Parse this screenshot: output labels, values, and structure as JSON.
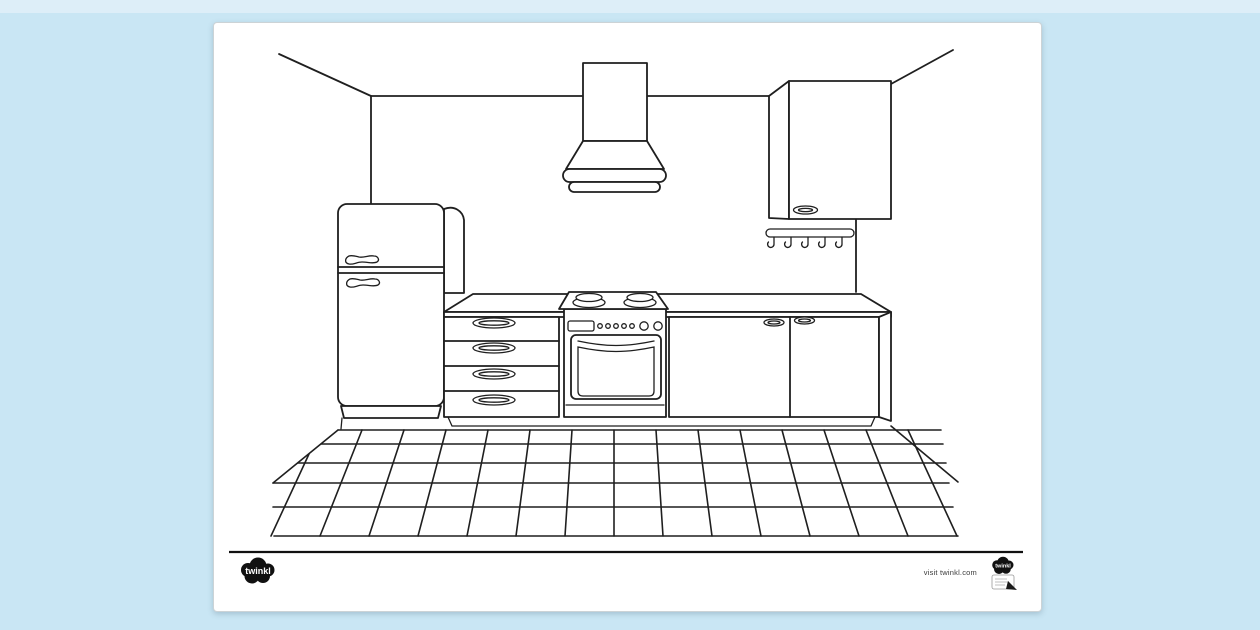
{
  "canvas": {
    "background_color": "#c9e6f4",
    "top_strip_color": "#ddeef8"
  },
  "paper": {
    "color": "#ffffff",
    "border_color": "#ccd3d6"
  },
  "ink_color": "#1f1f1f",
  "illustration": {
    "title": "Kitchen colouring page line drawing",
    "objects": [
      "room corner walls",
      "refrigerator with two handles",
      "cooker extractor hood",
      "wall cabinet with handle",
      "utensil rail with five hooks",
      "worktop",
      "four-drawer unit",
      "oven with hob burners and control knobs",
      "base cabinet with two doors",
      "tiled floor in perspective"
    ]
  },
  "footer": {
    "divider_color": "#111111",
    "logo_text": "twinkl",
    "visit_text": "visit twinkl.com",
    "badge": {
      "logo_text": "twinkl"
    }
  }
}
